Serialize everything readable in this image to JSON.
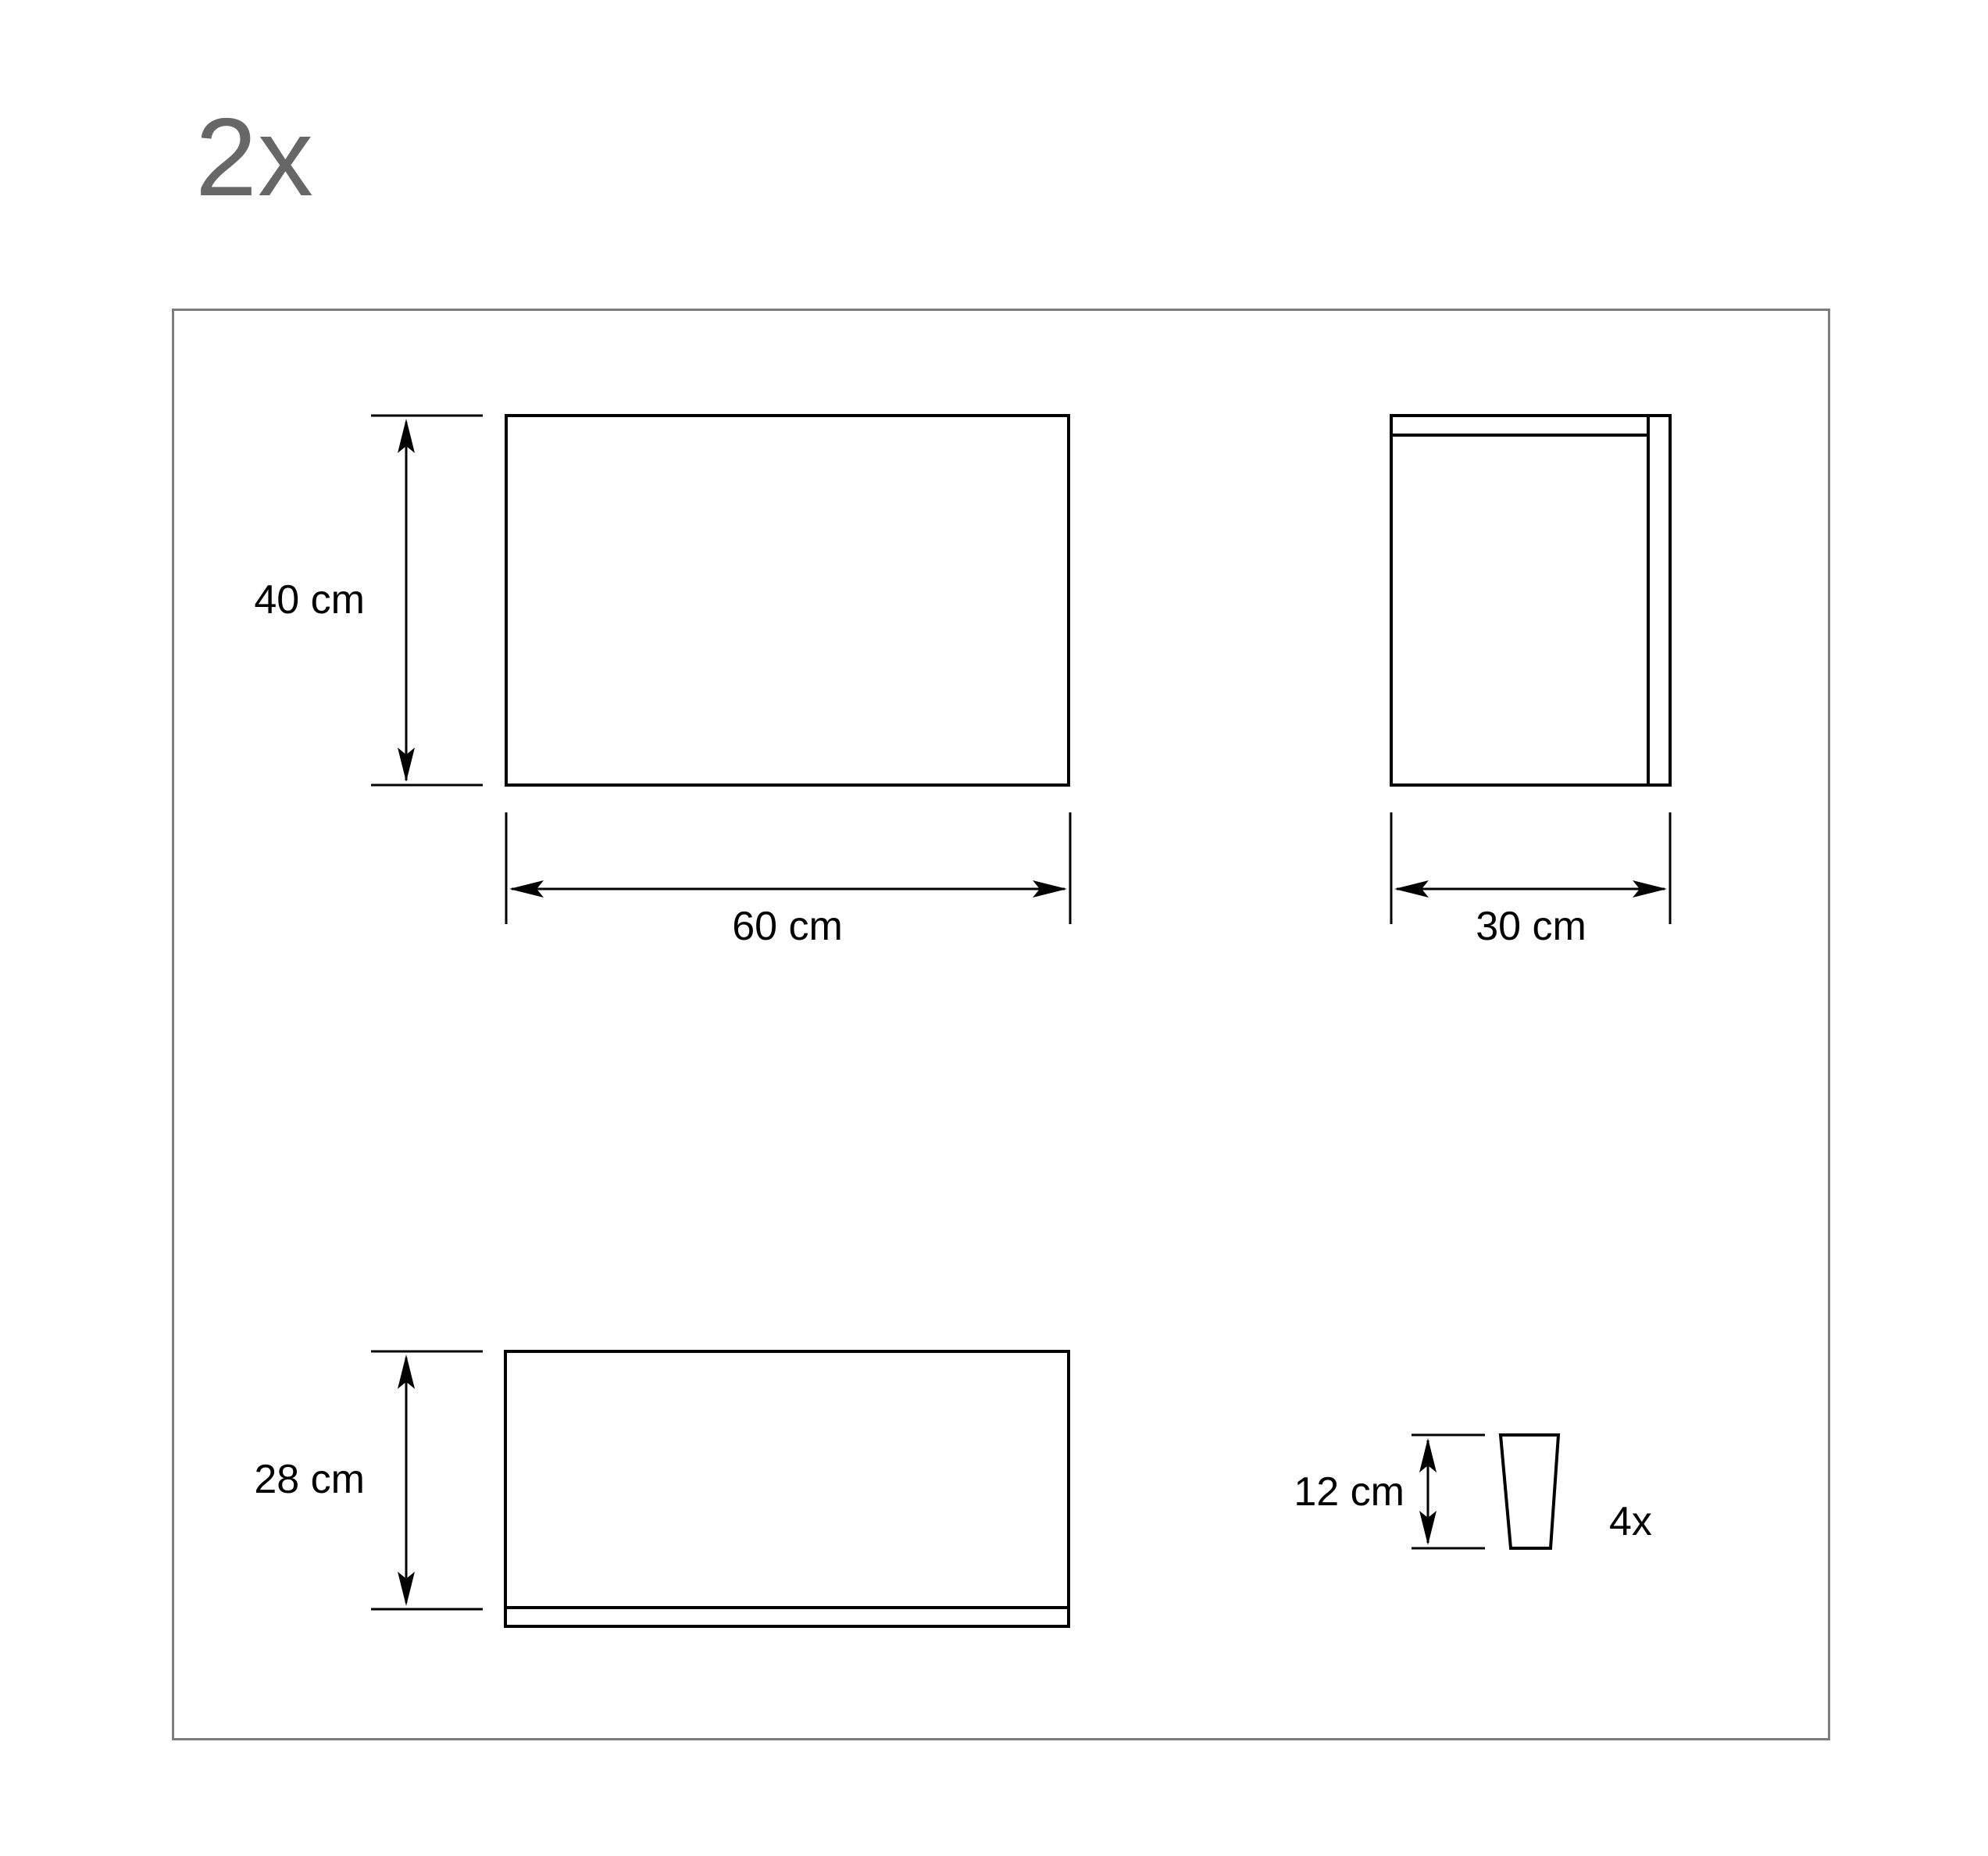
{
  "title": {
    "quantity": "2x"
  },
  "drawing": {
    "front_view": {
      "height": "40 cm",
      "width": "60 cm"
    },
    "side_view": {
      "width": "30 cm"
    },
    "back_panel_view": {
      "height": "28 cm"
    },
    "leg": {
      "height": "12 cm",
      "count": "4x"
    }
  },
  "colors": {
    "quantity_text": "#676767",
    "frame_border": "#7d7d7d",
    "ink": "#000000",
    "background": "#ffffff"
  }
}
